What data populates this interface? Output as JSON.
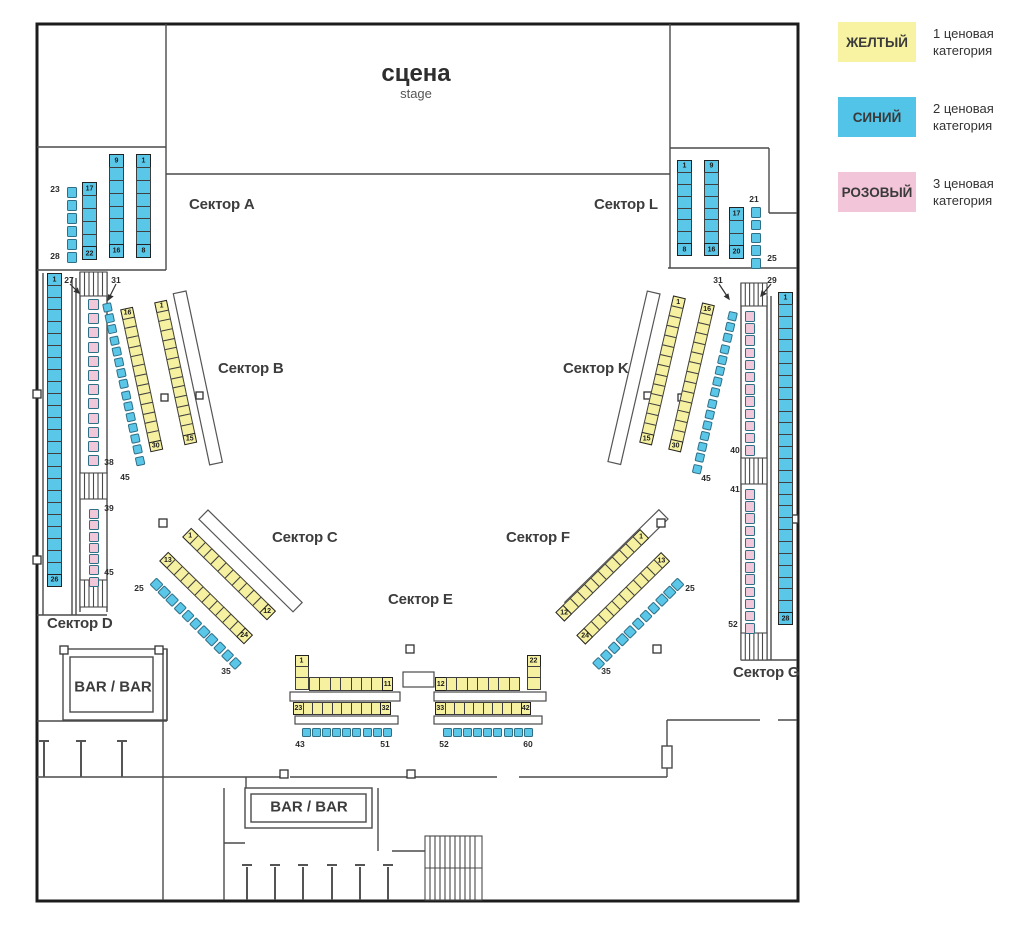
{
  "legend": {
    "items": [
      {
        "name": "ЖЕЛТЫЙ",
        "color": "#f8f3a2",
        "desc1": "1 ценовая",
        "desc2": "категория"
      },
      {
        "name": "СИНИЙ",
        "color": "#52c4e8",
        "desc1": "2 ценовая",
        "desc2": "категория"
      },
      {
        "name": "РОЗОВЫЙ",
        "color": "#f2c5d8",
        "desc1": "3 ценовая",
        "desc2": "категория"
      }
    ]
  },
  "stage": {
    "title": "сцена",
    "subtitle": "stage"
  },
  "bars": {
    "left": "BAR / BAR",
    "bottom": "BAR / BAR"
  },
  "map": {
    "category_colors": {
      "1": "#f6f1a1",
      "2": "#5ac6e8",
      "3": "#f0c8d9"
    },
    "sector_labels": [
      {
        "id": "A",
        "text": "Сектор A",
        "x": 189,
        "y": 196
      },
      {
        "id": "L",
        "text": "Сектор L",
        "x": 594,
        "y": 196
      },
      {
        "id": "B",
        "text": "Сектор B",
        "x": 218,
        "y": 360
      },
      {
        "id": "K",
        "text": "Сектор K",
        "x": 563,
        "y": 360
      },
      {
        "id": "C",
        "text": "Сектор C",
        "x": 272,
        "y": 529
      },
      {
        "id": "F",
        "text": "Сектор F",
        "x": 506,
        "y": 529
      },
      {
        "id": "E",
        "text": "Сектор E",
        "x": 388,
        "y": 591
      },
      {
        "id": "D",
        "text": "Сектор D",
        "x": 47,
        "y": 615
      },
      {
        "id": "G",
        "text": "Сектор G",
        "x": 733,
        "y": 664
      }
    ],
    "seat_groups": [
      {
        "id": "A-1-8",
        "sector": "A",
        "cat": "2",
        "kind": "strip",
        "x": 144,
        "y": 154,
        "angle": 90,
        "n": 8,
        "pitch": 13.9,
        "depth": 15,
        "first": "1",
        "last": "8"
      },
      {
        "id": "A-9-16",
        "sector": "A",
        "cat": "2",
        "kind": "strip",
        "x": 117,
        "y": 154,
        "angle": 90,
        "n": 8,
        "pitch": 13.9,
        "depth": 15,
        "first": "9",
        "last": "16"
      },
      {
        "id": "A-17-22",
        "sector": "A",
        "cat": "2",
        "kind": "strip",
        "x": 90,
        "y": 182,
        "angle": 90,
        "n": 6,
        "pitch": 13.9,
        "depth": 15,
        "first": "17",
        "last": "22"
      },
      {
        "id": "A-23-28",
        "sector": "A",
        "cat": "2",
        "kind": "singles",
        "x": 71.5,
        "y": 187,
        "angle": 90,
        "n": 6,
        "size": 10.5,
        "pitch": 13.1
      },
      {
        "id": "L-1-8",
        "sector": "L",
        "cat": "2",
        "kind": "strip",
        "x": 685,
        "y": 160,
        "angle": 90,
        "n": 8,
        "pitch": 12.9,
        "depth": 15,
        "first": "1",
        "last": "8"
      },
      {
        "id": "L-9-16",
        "sector": "L",
        "cat": "2",
        "kind": "strip",
        "x": 712,
        "y": 160,
        "angle": 90,
        "n": 8,
        "pitch": 12.9,
        "depth": 15,
        "first": "9",
        "last": "16"
      },
      {
        "id": "L-17-20",
        "sector": "L",
        "cat": "2",
        "kind": "strip",
        "x": 737,
        "y": 207,
        "angle": 90,
        "n": 4,
        "pitch": 13.8,
        "depth": 15,
        "first": "17",
        "last": "20"
      },
      {
        "id": "L-21-25",
        "sector": "L",
        "cat": "2",
        "kind": "singles",
        "x": 755.5,
        "y": 207,
        "angle": 90,
        "n": 5,
        "size": 10.5,
        "pitch": 12.75
      },
      {
        "id": "D-1-26",
        "sector": "D",
        "cat": "2",
        "kind": "strip",
        "x": 54.5,
        "y": 273,
        "angle": 90,
        "n": 26,
        "pitch": 13.04,
        "depth": 15,
        "first": "1",
        "last": "26"
      },
      {
        "id": "D-27-38",
        "sector": "D",
        "cat": "3",
        "kind": "singles",
        "x": 93.5,
        "y": 299,
        "angle": 90,
        "n": 12,
        "size": 11,
        "pitch": 14.2
      },
      {
        "id": "D-39-45",
        "sector": "D",
        "cat": "3",
        "kind": "singles",
        "x": 93.5,
        "y": 509,
        "angle": 90,
        "n": 7,
        "size": 10,
        "pitch": 11.3
      },
      {
        "id": "B-1-15",
        "sector": "B",
        "cat": "1",
        "kind": "strip",
        "x": 161,
        "y": 301,
        "angle": 78,
        "n": 15,
        "pitch": 10.7,
        "depth": 13,
        "first": "1",
        "last": "15"
      },
      {
        "id": "B-16-30",
        "sector": "B",
        "cat": "1",
        "kind": "strip",
        "x": 127,
        "y": 308,
        "angle": 78,
        "n": 15,
        "pitch": 10.7,
        "depth": 13,
        "first": "16",
        "last": "30"
      },
      {
        "id": "B-31-45",
        "sector": "B",
        "cat": "2",
        "kind": "singles",
        "x": 106.5,
        "y": 303,
        "angle": 78,
        "n": 15,
        "size": 9,
        "pitch": 11.2
      },
      {
        "id": "K-1-15",
        "sector": "K",
        "cat": "1",
        "kind": "strip",
        "x": 680,
        "y": 297,
        "angle": 103,
        "n": 15,
        "pitch": 11,
        "depth": 13,
        "first": "1",
        "last": "15"
      },
      {
        "id": "K-16-30",
        "sector": "K",
        "cat": "1",
        "kind": "strip",
        "x": 709,
        "y": 304,
        "angle": 103,
        "n": 15,
        "pitch": 11,
        "depth": 13,
        "first": "16",
        "last": "30"
      },
      {
        "id": "K-31-45",
        "sector": "K",
        "cat": "2",
        "kind": "singles",
        "x": 733.5,
        "y": 312,
        "angle": 103,
        "n": 15,
        "size": 9,
        "pitch": 11.2
      },
      {
        "id": "G-29-40",
        "sector": "G",
        "cat": "3",
        "kind": "singles",
        "x": 750,
        "y": 311,
        "angle": 90,
        "n": 12,
        "size": 10.5,
        "pitch": 12.2
      },
      {
        "id": "G-41-52",
        "sector": "G",
        "cat": "3",
        "kind": "singles",
        "x": 750,
        "y": 489,
        "angle": 90,
        "n": 12,
        "size": 10.5,
        "pitch": 12.2
      },
      {
        "id": "G-1-28",
        "sector": "G",
        "cat": "2",
        "kind": "strip",
        "x": 785.5,
        "y": 292,
        "angle": 90,
        "n": 28,
        "pitch": 12.86,
        "depth": 15,
        "first": "1",
        "last": "28"
      },
      {
        "id": "C-1-12",
        "sector": "C",
        "cat": "1",
        "kind": "strip",
        "x": 187,
        "y": 532,
        "angle": 44.5,
        "n": 12,
        "pitch": 10.8,
        "depth": 13,
        "first": "1",
        "last": "12"
      },
      {
        "id": "C-13-24",
        "sector": "C",
        "cat": "1",
        "kind": "strip",
        "x": 164,
        "y": 556,
        "angle": 44.5,
        "n": 12,
        "pitch": 10.8,
        "depth": 13,
        "first": "13",
        "last": "24"
      },
      {
        "id": "C-25-35",
        "sector": "C",
        "cat": "2",
        "kind": "singles",
        "x": 153,
        "y": 581,
        "angle": 45,
        "n": 11,
        "size": 9.5,
        "pitch": 11.2
      },
      {
        "id": "F-1-12",
        "sector": "F",
        "cat": "1",
        "kind": "strip",
        "x": 645,
        "y": 534,
        "angle": 135.5,
        "n": 12,
        "pitch": 10.8,
        "depth": 13,
        "first": "1",
        "last": "12"
      },
      {
        "id": "F-13-24",
        "sector": "F",
        "cat": "1",
        "kind": "strip",
        "x": 666,
        "y": 557,
        "angle": 135.5,
        "n": 12,
        "pitch": 10.8,
        "depth": 13,
        "first": "13",
        "last": "24"
      },
      {
        "id": "F-25-35",
        "sector": "F",
        "cat": "2",
        "kind": "singles",
        "x": 681,
        "y": 581,
        "angle": 135,
        "n": 11,
        "size": 9.5,
        "pitch": 11.2
      },
      {
        "id": "E-1-3",
        "sector": "E",
        "cat": "1",
        "kind": "strip",
        "x": 302,
        "y": 655,
        "angle": 90,
        "n": 3,
        "pitch": 12.2,
        "depth": 14,
        "first": "1"
      },
      {
        "id": "E-4-11",
        "sector": "E",
        "cat": "1",
        "kind": "strip",
        "x": 309,
        "y": 684,
        "angle": 0,
        "n": 8,
        "pitch": 11.4,
        "depth": 14,
        "last": "11"
      },
      {
        "id": "E-12-19",
        "sector": "E",
        "cat": "1",
        "kind": "strip",
        "x": 435,
        "y": 684,
        "angle": 0,
        "n": 8,
        "pitch": 11.5,
        "depth": 14,
        "first": "12"
      },
      {
        "id": "E-20-22",
        "sector": "E",
        "cat": "1",
        "kind": "strip",
        "x": 534,
        "y": 655,
        "angle": 90,
        "n": 3,
        "pitch": 12.2,
        "depth": 14,
        "first": "22"
      },
      {
        "id": "E-23-32",
        "sector": "E",
        "cat": "1",
        "kind": "strip",
        "x": 293,
        "y": 708.5,
        "angle": 0,
        "n": 10,
        "pitch": 10.7,
        "depth": 13,
        "first": "23",
        "last": "32"
      },
      {
        "id": "E-33-42",
        "sector": "E",
        "cat": "1",
        "kind": "strip",
        "x": 435,
        "y": 708.5,
        "angle": 0,
        "n": 10,
        "pitch": 10.5,
        "depth": 13,
        "first": "33",
        "last": "42"
      },
      {
        "id": "E-43-51",
        "sector": "E",
        "cat": "2",
        "kind": "singles",
        "x": 302,
        "y": 732,
        "angle": 0,
        "n": 9,
        "size": 9,
        "pitch": 10.1
      },
      {
        "id": "E-52-60",
        "sector": "E",
        "cat": "2",
        "kind": "singles",
        "x": 443,
        "y": 732,
        "angle": 0,
        "n": 9,
        "size": 9,
        "pitch": 10.1
      }
    ],
    "labels": [
      {
        "text": "23",
        "x": 55,
        "y": 189
      },
      {
        "text": "28",
        "x": 55,
        "y": 256
      },
      {
        "text": "21",
        "x": 754,
        "y": 199
      },
      {
        "text": "25",
        "x": 772,
        "y": 258
      },
      {
        "text": "27",
        "x": 69,
        "y": 280
      },
      {
        "text": "31",
        "x": 116,
        "y": 280
      },
      {
        "text": "38",
        "x": 109,
        "y": 462
      },
      {
        "text": "39",
        "x": 109,
        "y": 508
      },
      {
        "text": "45",
        "x": 109,
        "y": 572
      },
      {
        "text": "45",
        "x": 125,
        "y": 477
      },
      {
        "text": "25",
        "x": 139,
        "y": 588
      },
      {
        "text": "35",
        "x": 226,
        "y": 671
      },
      {
        "text": "25",
        "x": 690,
        "y": 588
      },
      {
        "text": "35",
        "x": 606,
        "y": 671
      },
      {
        "text": "45",
        "x": 706,
        "y": 478
      },
      {
        "text": "31",
        "x": 718,
        "y": 280
      },
      {
        "text": "29",
        "x": 772,
        "y": 280
      },
      {
        "text": "40",
        "x": 735,
        "y": 450
      },
      {
        "text": "41",
        "x": 735,
        "y": 489
      },
      {
        "text": "52",
        "x": 733,
        "y": 624
      },
      {
        "text": "43",
        "x": 300,
        "y": 744
      },
      {
        "text": "51",
        "x": 385,
        "y": 744
      },
      {
        "text": "52",
        "x": 444,
        "y": 744
      },
      {
        "text": "60",
        "x": 528,
        "y": 744
      }
    ]
  }
}
